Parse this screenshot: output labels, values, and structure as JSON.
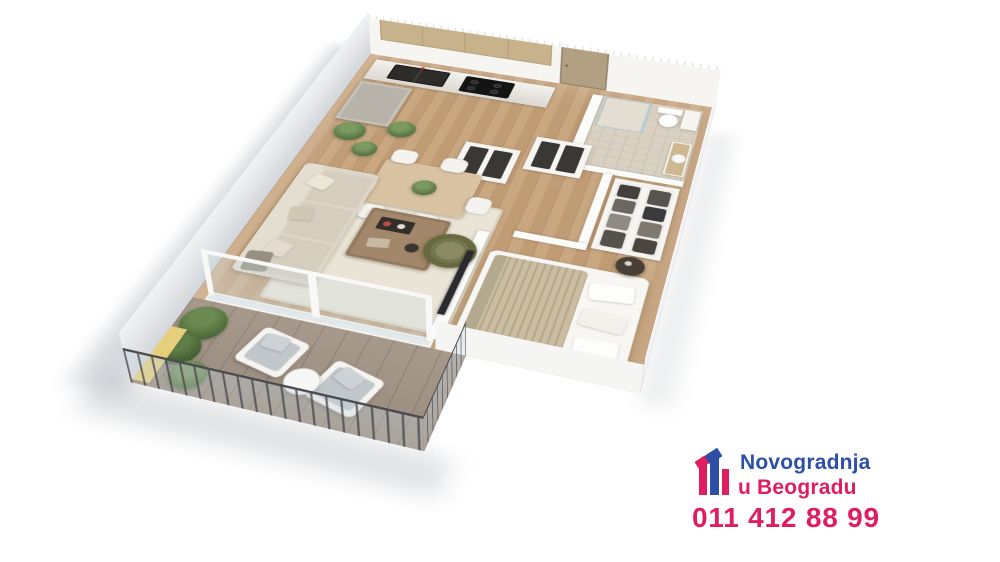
{
  "page": {
    "background_color": "#ffffff"
  },
  "render": {
    "description": "3D isometric cutaway render of a one-bedroom apartment floor plan",
    "rooms": [
      "kitchen",
      "dining-area",
      "living-room",
      "hallway",
      "bathroom",
      "wardrobe",
      "bedroom",
      "balcony"
    ],
    "floor_color": "#c4a17b",
    "wall_color": "#f6f5f2",
    "balcony_panel_color": "#e6cf7c",
    "armchair_color": "#74764e"
  },
  "brand": {
    "logo_icon": "buildings-icon",
    "line1": "Novogradnja",
    "line2": "u Beogradu",
    "phone": "011 412 88 99",
    "colors": {
      "blue": "#2d4fa5",
      "pink": "#e01e5f"
    }
  }
}
